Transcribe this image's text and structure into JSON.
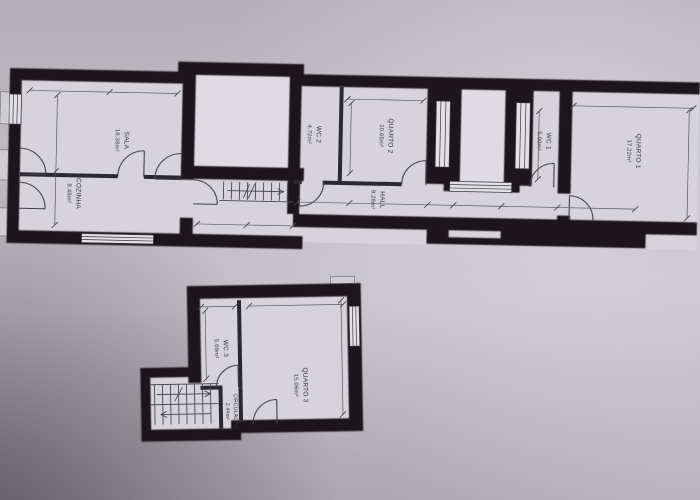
{
  "colors": {
    "paper": "#bcbac0",
    "room_fill": "#d6d4da",
    "wall": "#1a191d",
    "text": "#312f38"
  },
  "upper_floor": {
    "rooms": [
      {
        "key": "sala",
        "label": "SALA",
        "area": "18.38m²"
      },
      {
        "key": "cozinha",
        "label": "COZINHA",
        "area": "8.48m²"
      },
      {
        "key": "wc2",
        "label": "WC 2",
        "area": "4.72m²"
      },
      {
        "key": "quarto2",
        "label": "QUARTO 2",
        "area": "10.65m²"
      },
      {
        "key": "hall",
        "label": "HALL",
        "area": "9.28m²"
      },
      {
        "key": "wc1",
        "label": "WC 1",
        "area": "5.00m²"
      },
      {
        "key": "quarto1",
        "label": "QUARTO 1",
        "area": "17.22m²"
      }
    ]
  },
  "lower_floor": {
    "rooms": [
      {
        "key": "wc3",
        "label": "WC 3",
        "area": "5.09m²"
      },
      {
        "key": "quarto3",
        "label": "QUARTO 3",
        "area": "15.06m²"
      },
      {
        "key": "circulacao",
        "label": "CIRCULAÇÃO",
        "area": "2.44m²"
      }
    ]
  }
}
